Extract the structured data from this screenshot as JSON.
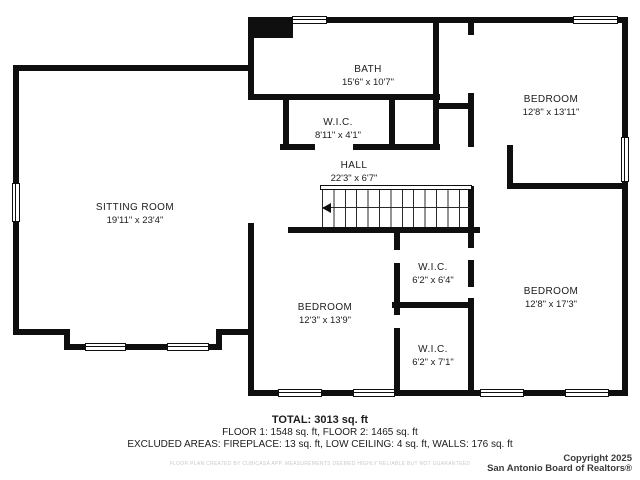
{
  "rooms": [
    {
      "name": "BATH",
      "dims": "15'6\" x 10'7\""
    },
    {
      "name": "W.I.C.",
      "dims": "8'11\" x 4'1\""
    },
    {
      "name": "HALL",
      "dims": "22'3\" x 6'7\""
    },
    {
      "name": "BEDROOM",
      "dims": "12'8\" x 13'11\""
    },
    {
      "name": "SITTING ROOM",
      "dims": "19'11\" x 23'4\""
    },
    {
      "name": "W.I.C.",
      "dims": "6'2\" x 6'4\""
    },
    {
      "name": "BEDROOM",
      "dims": "12'3\" x 13'9\""
    },
    {
      "name": "BEDROOM",
      "dims": "12'8\" x 17'3\""
    },
    {
      "name": "W.I.C.",
      "dims": "6'2\" x 7'1\""
    }
  ],
  "summary": {
    "total": "TOTAL: 3013 sq. ft",
    "floors": "FLOOR 1: 1548 sq. ft, FLOOR 2: 1465 sq. ft",
    "excluded": "EXCLUDED AREAS: FIREPLACE: 13 sq. ft, LOW CEILING: 4 sq. ft, WALLS: 176 sq. ft",
    "disclaimer": "FLOOR PLAN CREATED BY CUBICASA APP. MEASUREMENTS DEEMED HIGHLY RELIABLE BUT NOT GUARANTEED"
  },
  "copyright": {
    "line1": "Copyright 2025",
    "line2": "San Antonio Board of Realtors®"
  },
  "colors": {
    "wall": "#0f0f0f",
    "text": "#1c1c1c",
    "disclaimer_text": "#c9c9c9"
  },
  "icons": {
    "stairs": "staircase-with-direction-arrow",
    "windows": "double-line-window-symbol"
  }
}
